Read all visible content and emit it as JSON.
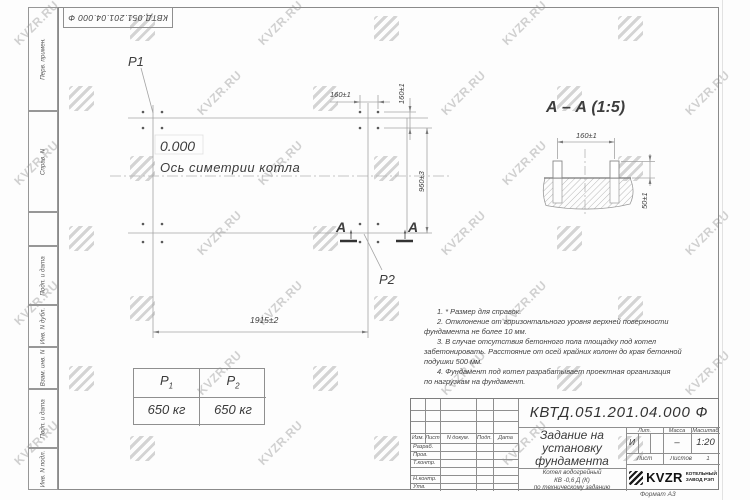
{
  "watermark": {
    "text": "KVZR.RU"
  },
  "corner_stamp": {
    "doc_number": "КВТД.051.201.04.000 Ф"
  },
  "margin": {
    "labels": [
      "Перв. примен.",
      "Справ. N",
      "Подп. и дата",
      "Инв. N дубл.",
      "Взам. инв. N",
      "Подп. и дата",
      "Инв. N подл."
    ]
  },
  "plan": {
    "level_mark": "0.000",
    "axis_label": "Ось симетрии котла",
    "p1_label": "P1",
    "p2_label": "P2",
    "dim_top": "160±1",
    "dim_right": "160±1",
    "dim_height": "960±3",
    "dim_width": "1915±2",
    "section_letter_left": "А",
    "section_letter_right": "А"
  },
  "section": {
    "title": "А – А (1:5)",
    "dim_width": "160±1",
    "dim_height": "50±1"
  },
  "load_table": {
    "col1": {
      "base": "P",
      "sub": "1",
      "value": "650 кг"
    },
    "col2": {
      "base": "P",
      "sub": "2",
      "value": "650 кг"
    }
  },
  "notes": {
    "lines": [
      "1. * Размер для справок.",
      "2. Отклонение от горизонтального уровня верхней поверхности",
      "фундамента не более 10 мм.",
      "3. В случае отсутствия бетонного пола площадку под котел",
      "забетонировать. Расстояние от осей крайних колонн до края бетонной",
      "подушки 500 мм.",
      "4. Фундамент под котел разрабатывает проектная организация",
      "по нагрузкам на фундамент."
    ]
  },
  "title_block": {
    "doc_number": "КВТД.051.201.04.000  Ф",
    "title_lines": [
      "Задание на",
      "установку",
      "фундамента"
    ],
    "subtitle_lines": [
      "Котел водогрейный",
      "КВ -0,6 Д (К)",
      "по техническому заданию"
    ],
    "header_cols": [
      "Изм.",
      "Лист",
      "N докум.",
      "Подп.",
      "Дата"
    ],
    "row_labels": [
      "Разраб.",
      "Пров.",
      "Т.контр.",
      "Н.контр.",
      "Утв."
    ],
    "lit_header": "Лит.",
    "mass_header": "Масса",
    "scale_header": "Масштаб",
    "lit_value": "И",
    "mass_value": "–",
    "scale_value": "1:20",
    "sheet_label": "Лист",
    "sheets_label": "Листов",
    "sheets_value": "1",
    "company": {
      "name": "KVZR",
      "line1": "КОТЕЛЬНЫЙ",
      "line2": "ЗАВОД РЭП"
    },
    "format_label": "Формат А3"
  }
}
